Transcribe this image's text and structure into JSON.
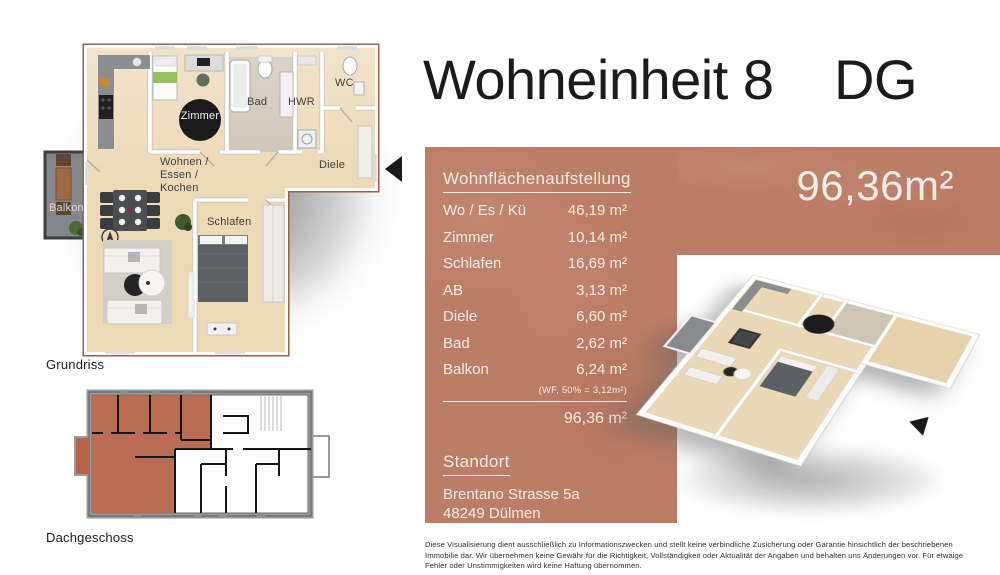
{
  "header": {
    "title": "Wohneinheit 8",
    "floor_tag": "DG"
  },
  "area_panel": {
    "heading": "Wohnflächenaufstellung",
    "rows": [
      {
        "label": "Wo / Es / Kü",
        "value": "46,19 m²"
      },
      {
        "label": "Zimmer",
        "value": "10,14 m²"
      },
      {
        "label": "Schlafen",
        "value": "16,69 m²"
      },
      {
        "label": "AB",
        "value": "3,13 m²"
      },
      {
        "label": "Diele",
        "value": "6,60 m²"
      },
      {
        "label": "Bad",
        "value": "2,62 m²"
      },
      {
        "label": "Balkon",
        "value": "6,24 m²"
      }
    ],
    "balkon_note": "(WF, 50% = 3,12m²)",
    "total": "96,36 m²",
    "big_area": "96,36m²",
    "standort_heading": "Standort",
    "address_line1": "Brentano Strasse 5a",
    "address_line2": "48249 Dülmen"
  },
  "floor_plan": {
    "caption": "Grundriss",
    "labels": {
      "wohnen": "Wohnen /\nEssen /\nKochen",
      "zimmer": "Zimmer",
      "bad": "Bad",
      "hwr": "HWR",
      "wc": "WC",
      "diele": "Diele",
      "schlafen": "Schlafen",
      "balkon": "Balkon"
    }
  },
  "locator": {
    "caption": "Dachgeschoss"
  },
  "disclaimer": "Diese Visualisierung dient ausschließlich zu Informationszwecken und stellt keine verbindliche Zusicherung oder Garantie hinsichtlich der beschriebenen Immobilie dar.  Wir übernehmen keine Gewähr für die Richtigkeit, Vollständigkeit oder Aktualität der Angaben und behalten uns Änderungen vor. Für etwaige Fehler oder Unstimmigkeiten wird keine Haftung übernommen.",
  "colors": {
    "accent_terracotta": "#bc7d66",
    "locator_highlight": "#b5654a",
    "panel_text": "#f3ece5",
    "title_text": "#1b1b1b"
  }
}
